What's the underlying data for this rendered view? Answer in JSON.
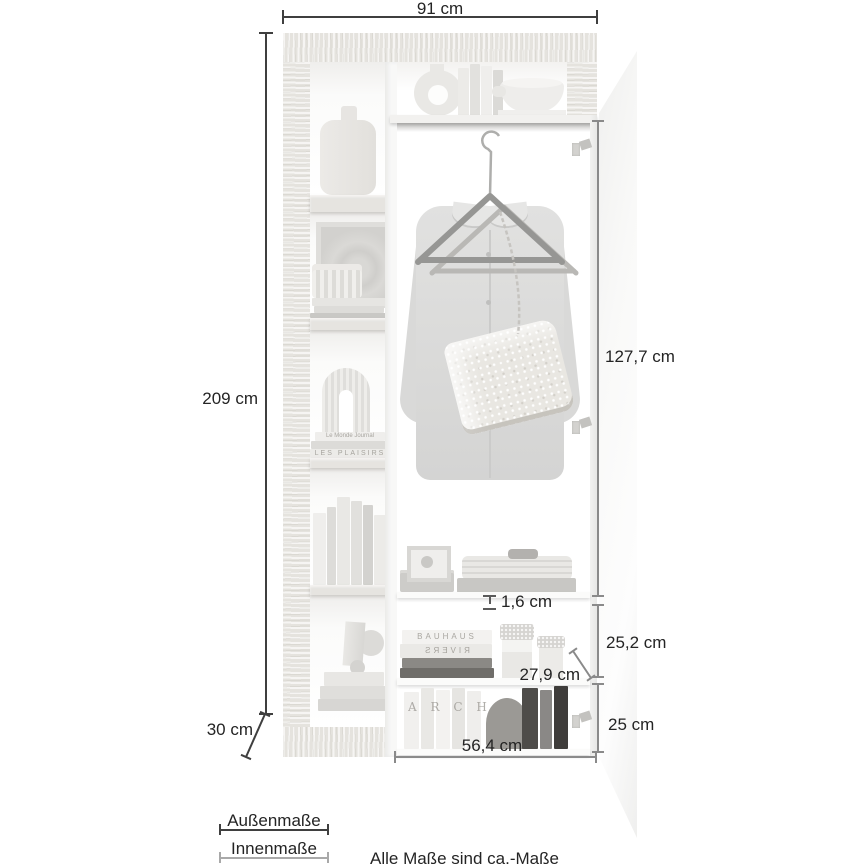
{
  "dimensions": {
    "outer_width": "91 cm",
    "outer_height": "209 cm",
    "outer_depth": "30 cm",
    "inner_height": "127,7 cm",
    "shelf_thickness": "1,6 cm",
    "upper_compartment_height": "25,2 cm",
    "inner_depth": "27,9 cm",
    "lower_compartment_height": "25 cm",
    "inner_width": "56,4 cm"
  },
  "legend": {
    "outer_label": "Außenmaße",
    "inner_label": "Innenmaße",
    "note": "Alle Maße sind ca.-Maße"
  },
  "decor_text": {
    "book_bauhaus": "BAUHAUS",
    "book_rivers": "RIVERS",
    "book_plaisirs": "LES PLAISIRS",
    "book_journal": "Le Monde Journal",
    "binder_arch": "A R C H"
  },
  "colors": {
    "outer_dimension_line": "#3f3f3f",
    "inner_dimension_line": "#8a8a8a",
    "wood": "#eae8e4",
    "background": "#ffffff"
  }
}
